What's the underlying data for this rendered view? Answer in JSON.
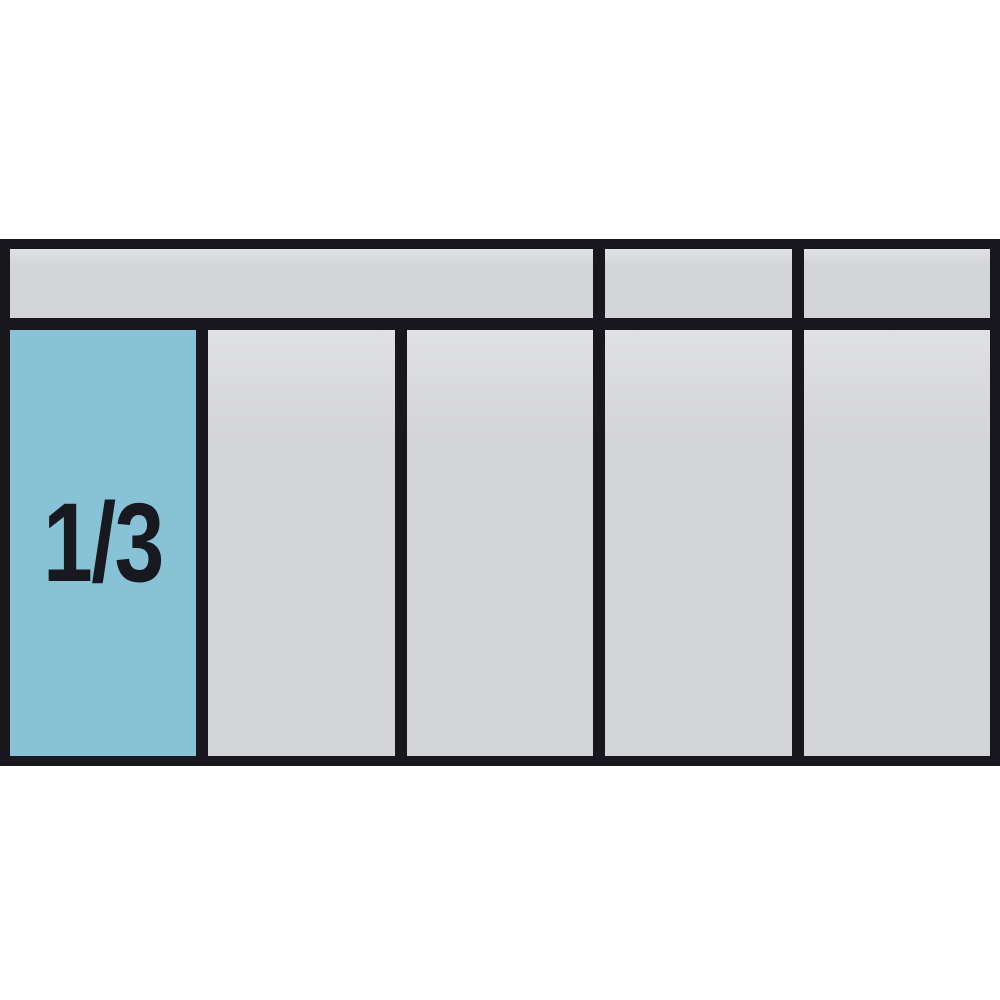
{
  "tray": {
    "highlight_label": "1/3",
    "colors": {
      "background": "#ffffff",
      "frame": "#17171d",
      "slot_gray": "#d3d4d6",
      "slot_highlight": "#87c2d6",
      "label_text": "#181820"
    },
    "header_row": {
      "cells": [
        {
          "name": "lid-compartment-wide",
          "span": 3
        },
        {
          "name": "lid-compartment-4",
          "span": 1
        },
        {
          "name": "lid-compartment-5",
          "span": 1
        }
      ]
    },
    "slot_row": {
      "cells": [
        {
          "name": "slot-1",
          "highlighted": true,
          "label": "1/3"
        },
        {
          "name": "slot-2",
          "highlighted": false,
          "label": ""
        },
        {
          "name": "slot-3",
          "highlighted": false,
          "label": ""
        },
        {
          "name": "slot-4",
          "highlighted": false,
          "label": ""
        },
        {
          "name": "slot-5",
          "highlighted": false,
          "label": ""
        }
      ]
    }
  }
}
